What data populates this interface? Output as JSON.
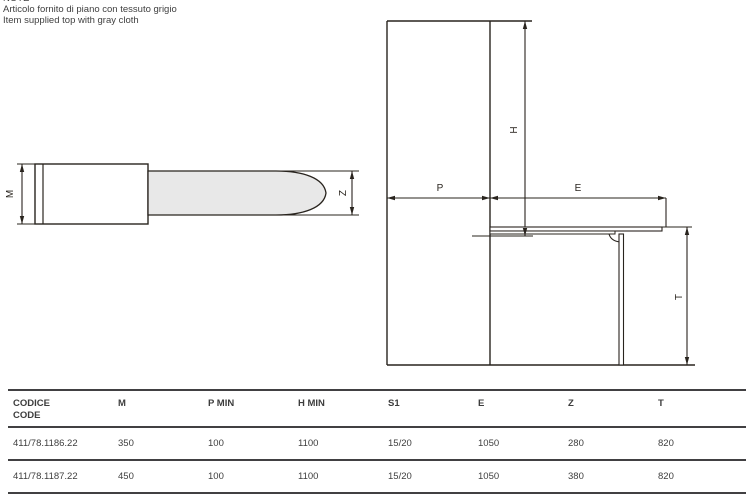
{
  "note": {
    "line0": "NOTE",
    "line1": "Articolo fornito di piano con tessuto grigio",
    "line2": "Item supplied top with gray cloth"
  },
  "drawings": {
    "top_view": {
      "m_label": "M",
      "z_label": "Z"
    },
    "side_view": {
      "p_label": "P",
      "e_label": "E",
      "h_label": "H",
      "t_label": "T"
    }
  },
  "colors": {
    "line": "#29241e",
    "board_fill": "#e8e8e8",
    "text": "#3d3d3d",
    "rule": "#414042"
  },
  "table": {
    "header": {
      "codice_line1": "CODICE",
      "codice_line2": "CODE",
      "cols": [
        "M",
        "P MIN",
        "H MIN",
        "S1",
        "E",
        "Z",
        "T"
      ]
    },
    "rows": [
      {
        "code": "411/78.1186.22",
        "m": "350",
        "p_min": "100",
        "h_min": "1100",
        "s1": "15/20",
        "e": "1050",
        "z": "280",
        "t": "820"
      },
      {
        "code": "411/78.1187.22",
        "m": "450",
        "p_min": "100",
        "h_min": "1100",
        "s1": "15/20",
        "e": "1050",
        "z": "380",
        "t": "820"
      }
    ]
  }
}
